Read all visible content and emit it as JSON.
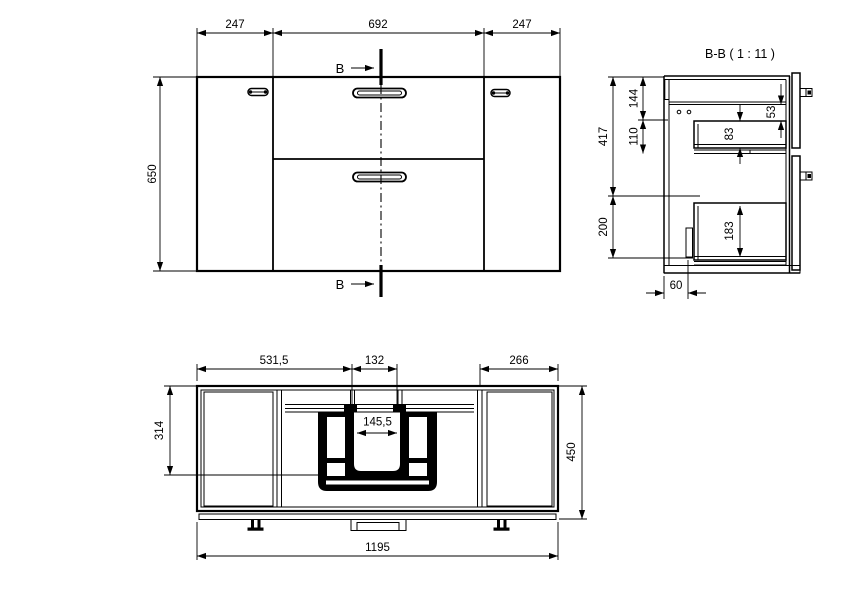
{
  "meta": {
    "background_color": "#ffffff",
    "line_color": "#000000",
    "drawing_type": "technical drawing, bathroom vanity cabinet, 3 views"
  },
  "front_view": {
    "dim_left_door_width": "247",
    "dim_center_width": "692",
    "dim_right_door_width": "247",
    "dim_total_height": "650",
    "section_marker_top": "B",
    "section_marker_bottom": "B"
  },
  "section_view": {
    "title": "B-B ( 1 : 11 )",
    "dim_upper_zone_height": "417",
    "dim_top_panel_height": "144",
    "dim_upper_opening_height": "110",
    "dim_lower_zone_height": "200",
    "dim_top_clearance": "53",
    "dim_upper_drawer_depth": "83",
    "dim_lower_drawer_depth": "183",
    "dim_bracket_offset": "60"
  },
  "plan_view": {
    "dim_left_to_cutout": "531,5",
    "dim_cutout_width": "132",
    "dim_right_module_width": "266",
    "dim_inner_notch_width": "145,5",
    "dim_front_to_cutout_depth": "314",
    "dim_total_depth": "450",
    "dim_total_width": "1195"
  }
}
